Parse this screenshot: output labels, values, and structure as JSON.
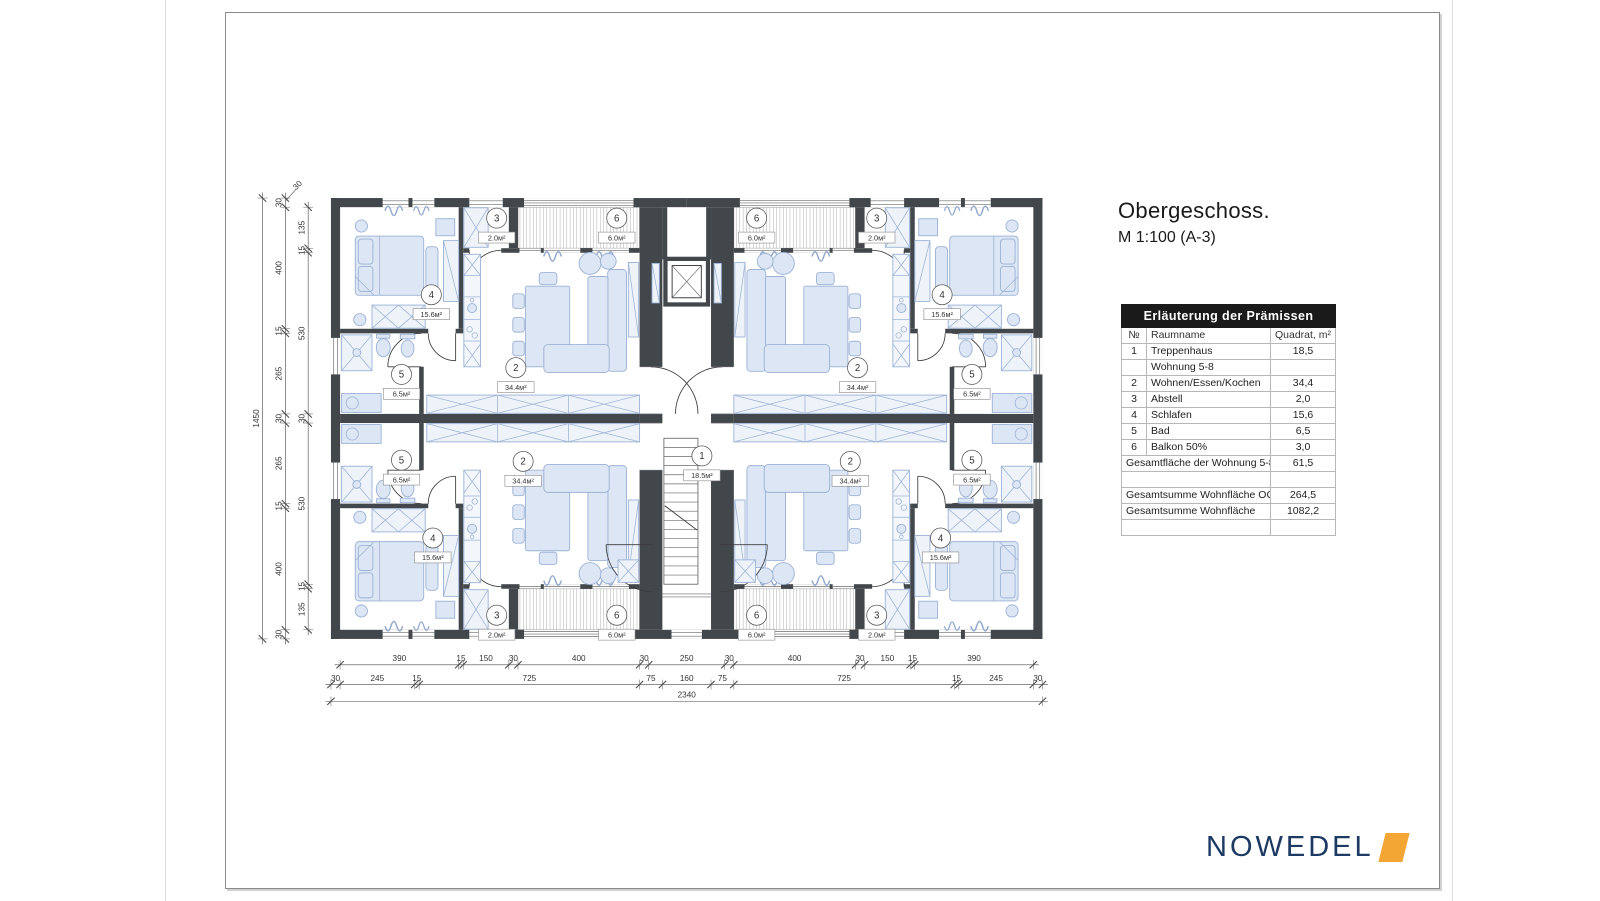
{
  "page": {
    "title": "Obergeschoss.",
    "subtitle": "M 1:100 (A-3)"
  },
  "logo": {
    "text": "NOWEDEL"
  },
  "table": {
    "header": "Erläuterung der Prämissen",
    "columns": [
      "№",
      "Raumname",
      "Quadrat, m²"
    ],
    "rows": [
      {
        "no": "1",
        "name": "Treppenhaus",
        "value": "18,5"
      },
      {
        "section": "Wohnung 5-8"
      },
      {
        "no": "2",
        "name": "Wohnen/Essen/Kochen",
        "value": "34,4"
      },
      {
        "no": "3",
        "name": "Abstell",
        "value": "2,0"
      },
      {
        "no": "4",
        "name": "Schlafen",
        "value": "15,6"
      },
      {
        "no": "5",
        "name": "Bad",
        "value": "6,5"
      },
      {
        "no": "6",
        "name": "Balkon 50%",
        "value": "3,0"
      },
      {
        "total": "Gesamtfläche der Wohnung 5-8",
        "value": "61,5"
      },
      {
        "blank": true
      },
      {
        "total": "Gesamtsumme Wohnfläche OG",
        "value": "264,5"
      },
      {
        "total": "Gesamtsumme Wohnfläche",
        "value": "1082,2"
      },
      {
        "blank": true
      }
    ]
  },
  "plan": {
    "room_labels": [
      {
        "n": "1",
        "a": "18.5м²",
        "x": 1220,
        "y": 848
      },
      {
        "n": "4",
        "a": "15.6м²",
        "x": 330,
        "y": 318
      },
      {
        "n": "3",
        "a": "2.0м²",
        "x": 545,
        "y": 66
      },
      {
        "n": "6",
        "a": "6.0м²",
        "x": 940,
        "y": 66
      },
      {
        "n": "2",
        "a": "34.4м²",
        "x": 608,
        "y": 558
      },
      {
        "n": "5",
        "a": "6.5м²",
        "x": 232,
        "y": 580
      },
      {
        "n": "4",
        "a": "15.6м²",
        "x": 2010,
        "y": 318
      },
      {
        "n": "3",
        "a": "2.0м²",
        "x": 1795,
        "y": 66
      },
      {
        "n": "6",
        "a": "6.0м²",
        "x": 1400,
        "y": 66
      },
      {
        "n": "2",
        "a": "34.4м²",
        "x": 1732,
        "y": 558
      },
      {
        "n": "5",
        "a": "6.5м²",
        "x": 2108,
        "y": 580
      },
      {
        "n": "5",
        "a": "6.5м²",
        "x": 232,
        "y": 862
      },
      {
        "n": "2",
        "a": "34.4м²",
        "x": 632,
        "y": 866
      },
      {
        "n": "4",
        "a": "15.6м²",
        "x": 335,
        "y": 1118
      },
      {
        "n": "3",
        "a": "2.0м²",
        "x": 545,
        "y": 1372
      },
      {
        "n": "6",
        "a": "6.0м²",
        "x": 940,
        "y": 1372
      },
      {
        "n": "5",
        "a": "6.5м²",
        "x": 2108,
        "y": 862
      },
      {
        "n": "2",
        "a": "34.4м²",
        "x": 1708,
        "y": 866
      },
      {
        "n": "4",
        "a": "15.6м²",
        "x": 2005,
        "y": 1118
      },
      {
        "n": "3",
        "a": "2.0м²",
        "x": 1795,
        "y": 1372
      },
      {
        "n": "6",
        "a": "6.0м²",
        "x": 1400,
        "y": 1372
      }
    ],
    "dims": {
      "bottom": [
        {
          "y": 1535,
          "x0": 30,
          "segs": [
            "390",
            "15",
            "150",
            "30",
            "400",
            "30",
            "250",
            "30",
            "400",
            "30",
            "150",
            "15",
            "390"
          ]
        },
        {
          "y": 1600,
          "x0": 0,
          "segs": [
            "30",
            "245",
            "15",
            "725",
            "75",
            "160",
            "75",
            "725",
            "15",
            "245",
            "30"
          ]
        },
        {
          "y": 1655,
          "x0": 0,
          "segs": [
            "2340"
          ]
        }
      ],
      "left": [
        {
          "x": -225,
          "y0": 0,
          "segs": [
            "1450"
          ]
        },
        {
          "x": -150,
          "y0": 0,
          "segs": [
            "30",
            "400",
            "15",
            "265",
            "30",
            "265",
            "15",
            "400",
            "30"
          ]
        },
        {
          "x": -75,
          "y0": 30,
          "segs": [
            "135",
            "15",
            "530",
            "30",
            "530",
            "15",
            "135"
          ]
        }
      ],
      "corner_label": "30"
    }
  },
  "colors": {
    "wall": "#42474c",
    "furniture_fill": "#dce6f4",
    "furniture_line": "#9cb3d6",
    "logo_navy": "#1d3a63",
    "logo_orange": "#f3a634",
    "table_header_bg": "#1a1a1a"
  }
}
